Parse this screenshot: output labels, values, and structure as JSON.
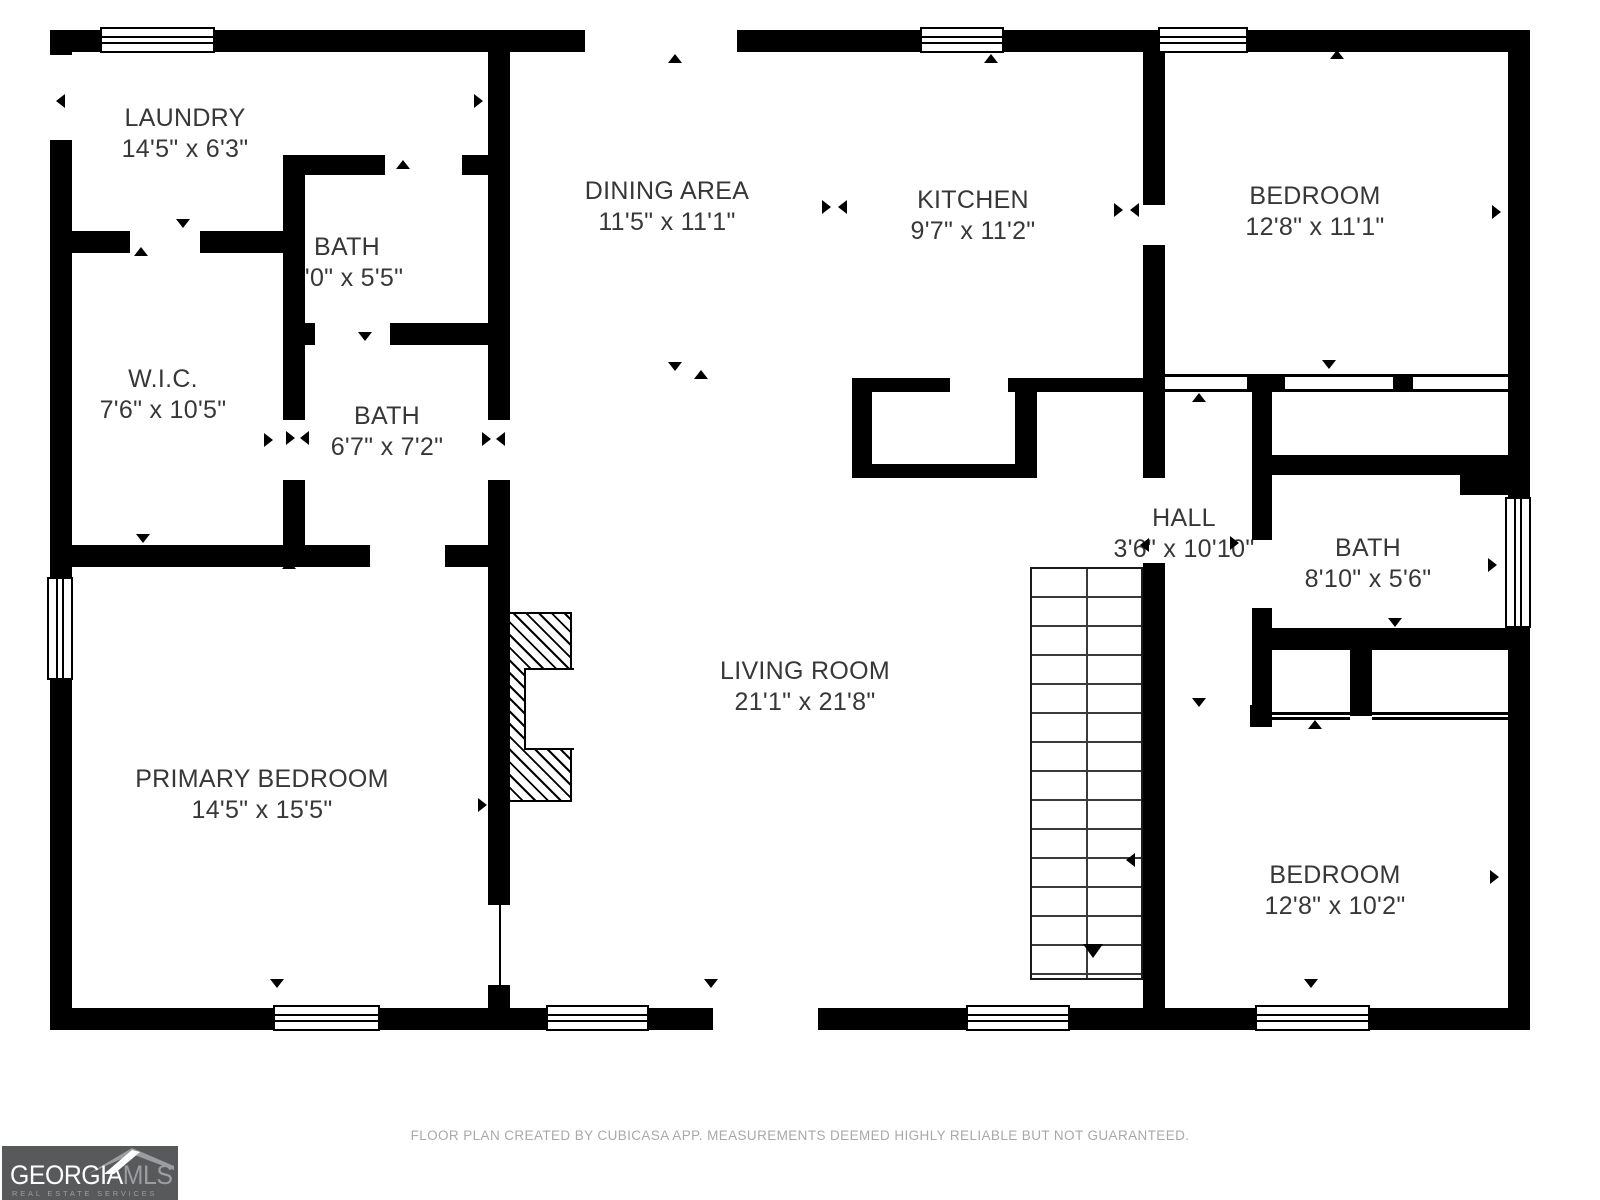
{
  "footer": {
    "disclaimer": "FLOOR PLAN CREATED BY CUBICASA APP. MEASUREMENTS DEEMED HIGHLY RELIABLE BUT NOT GUARANTEED."
  },
  "logo": {
    "brand_primary": "GEORGIA",
    "brand_secondary": "MLS",
    "tagline": "REAL ESTATE SERVICES"
  },
  "colors": {
    "wall": "#000000",
    "background": "#ffffff",
    "label_text": "#373737",
    "footer_text": "#a9a9a9",
    "logo_background": "#58595b",
    "logo_secondary": "#9b9da0"
  },
  "rooms": [
    {
      "id": "laundry",
      "name": "LAUNDRY",
      "dims": "14'5\" x 6'3\"",
      "cx": 185,
      "cy": 134
    },
    {
      "id": "bath-upper",
      "name": "BATH",
      "dims": "9'0\" x 5'5\"",
      "cx": 347,
      "cy": 263
    },
    {
      "id": "wic",
      "name": "W.I.C.",
      "dims": "7'6\" x 10'5\"",
      "cx": 163,
      "cy": 395
    },
    {
      "id": "bath-middle",
      "name": "BATH",
      "dims": "6'7\" x 7'2\"",
      "cx": 387,
      "cy": 432
    },
    {
      "id": "primary-bedroom",
      "name": "PRIMARY BEDROOM",
      "dims": "14'5\" x 15'5\"",
      "cx": 262,
      "cy": 795
    },
    {
      "id": "dining-area",
      "name": "DINING AREA",
      "dims": "11'5\" x 11'1\"",
      "cx": 667,
      "cy": 207
    },
    {
      "id": "kitchen",
      "name": "KITCHEN",
      "dims": "9'7\" x 11'2\"",
      "cx": 973,
      "cy": 216
    },
    {
      "id": "bedroom-top",
      "name": "BEDROOM",
      "dims": "12'8\" x 11'1\"",
      "cx": 1315,
      "cy": 212
    },
    {
      "id": "hall",
      "name": "HALL",
      "dims": "3'6\" x 10'10\"",
      "cx": 1184,
      "cy": 534
    },
    {
      "id": "bath-right",
      "name": "BATH",
      "dims": "8'10\" x 5'6\"",
      "cx": 1368,
      "cy": 564
    },
    {
      "id": "living-room",
      "name": "LIVING ROOM",
      "dims": "21'1\" x 21'8\"",
      "cx": 805,
      "cy": 687
    },
    {
      "id": "bedroom-bottom",
      "name": "BEDROOM",
      "dims": "12'8\" x 10'2\"",
      "cx": 1335,
      "cy": 891
    }
  ],
  "plan": {
    "walls": [
      [
        50,
        30,
        50,
        22
      ],
      [
        215,
        30,
        370,
        22
      ],
      [
        737,
        30,
        183,
        22
      ],
      [
        1004,
        30,
        154,
        22
      ],
      [
        1248,
        30,
        282,
        22
      ],
      [
        50,
        1008,
        223,
        22
      ],
      [
        380,
        1008,
        166,
        22
      ],
      [
        649,
        1008,
        64,
        22
      ],
      [
        818,
        1008,
        148,
        22
      ],
      [
        1070,
        1008,
        185,
        22
      ],
      [
        1370,
        1008,
        160,
        22
      ],
      [
        50,
        30,
        22,
        25
      ],
      [
        50,
        140,
        22,
        437
      ],
      [
        50,
        680,
        22,
        350
      ],
      [
        1508,
        30,
        22,
        467
      ],
      [
        1508,
        628,
        22,
        402
      ],
      [
        488,
        52,
        22,
        368
      ],
      [
        488,
        480,
        22,
        425
      ],
      [
        488,
        985,
        22,
        23
      ],
      [
        50,
        231,
        80,
        22
      ],
      [
        200,
        231,
        105,
        22
      ],
      [
        283,
        157,
        22,
        166
      ],
      [
        283,
        155,
        102,
        20
      ],
      [
        462,
        155,
        48,
        20
      ],
      [
        283,
        323,
        32,
        22
      ],
      [
        390,
        323,
        120,
        22
      ],
      [
        283,
        345,
        22,
        75
      ],
      [
        283,
        480,
        22,
        65
      ],
      [
        50,
        545,
        320,
        22
      ],
      [
        445,
        545,
        65,
        22
      ],
      [
        852,
        378,
        98,
        14
      ],
      [
        1008,
        378,
        135,
        14
      ],
      [
        852,
        392,
        20,
        86
      ],
      [
        1015,
        392,
        22,
        86
      ],
      [
        852,
        464,
        185,
        14
      ],
      [
        1143,
        52,
        22,
        153
      ],
      [
        1143,
        245,
        22,
        233
      ],
      [
        1143,
        563,
        22,
        445
      ],
      [
        1247,
        374,
        38,
        18
      ],
      [
        1393,
        374,
        20,
        18
      ],
      [
        1252,
        390,
        20,
        150
      ],
      [
        1252,
        608,
        20,
        27
      ],
      [
        1272,
        455,
        188,
        20
      ],
      [
        1460,
        455,
        48,
        40
      ],
      [
        1252,
        628,
        256,
        22
      ],
      [
        1252,
        650,
        20,
        66
      ],
      [
        1350,
        650,
        22,
        66
      ],
      [
        1250,
        705,
        22,
        22
      ]
    ],
    "windows": [
      [
        100,
        27,
        115,
        26,
        "h"
      ],
      [
        920,
        27,
        84,
        26,
        "h"
      ],
      [
        1158,
        27,
        90,
        26,
        "h"
      ],
      [
        273,
        1005,
        107,
        26,
        "h"
      ],
      [
        546,
        1005,
        103,
        26,
        "h"
      ],
      [
        966,
        1005,
        104,
        26,
        "h"
      ],
      [
        1255,
        1005,
        115,
        26,
        "h"
      ],
      [
        47,
        577,
        26,
        103,
        "v"
      ],
      [
        1505,
        497,
        26,
        131,
        "v"
      ]
    ],
    "rails": [
      [
        1165,
        374,
        343,
        18
      ],
      [
        1272,
        712,
        78,
        8
      ],
      [
        1372,
        712,
        136,
        8
      ]
    ],
    "thin_lines": [
      [
        499,
        905,
        2,
        103
      ]
    ],
    "markers": [
      [
        "l",
        56,
        94
      ],
      [
        "r",
        474,
        94
      ],
      [
        "d",
        176,
        219
      ],
      [
        "u",
        134,
        247
      ],
      [
        "u",
        668,
        54
      ],
      [
        "u",
        984,
        54
      ],
      [
        "r",
        822,
        200
      ],
      [
        "l",
        838,
        200
      ],
      [
        "r",
        1114,
        203
      ],
      [
        "l",
        1130,
        203
      ],
      [
        "u",
        1330,
        50
      ],
      [
        "r",
        1492,
        205
      ],
      [
        "d",
        1322,
        360
      ],
      [
        "l",
        56,
        431
      ],
      [
        "r",
        264,
        433
      ],
      [
        "d",
        136,
        534
      ],
      [
        "r",
        286,
        431
      ],
      [
        "l",
        300,
        431
      ],
      [
        "r",
        482,
        432
      ],
      [
        "l",
        496,
        432
      ],
      [
        "u",
        396,
        160
      ],
      [
        "d",
        358,
        332
      ],
      [
        "l",
        288,
        278
      ],
      [
        "r",
        492,
        278
      ],
      [
        "u",
        282,
        560
      ],
      [
        "l",
        56,
        797
      ],
      [
        "r",
        478,
        798
      ],
      [
        "d",
        270,
        979
      ],
      [
        "d",
        668,
        362
      ],
      [
        "u",
        694,
        370
      ],
      [
        "d",
        704,
        979
      ],
      [
        "l",
        1126,
        853
      ],
      [
        "u",
        1192,
        393
      ],
      [
        "d",
        1192,
        698
      ],
      [
        "l",
        1140,
        538
      ],
      [
        "r",
        1230,
        536
      ],
      [
        "u",
        1388,
        458
      ],
      [
        "d",
        1388,
        618
      ],
      [
        "r",
        1488,
        558
      ],
      [
        "u",
        1308,
        720
      ],
      [
        "l",
        1148,
        870
      ],
      [
        "r",
        1490,
        870
      ],
      [
        "d",
        1304,
        979
      ]
    ]
  }
}
